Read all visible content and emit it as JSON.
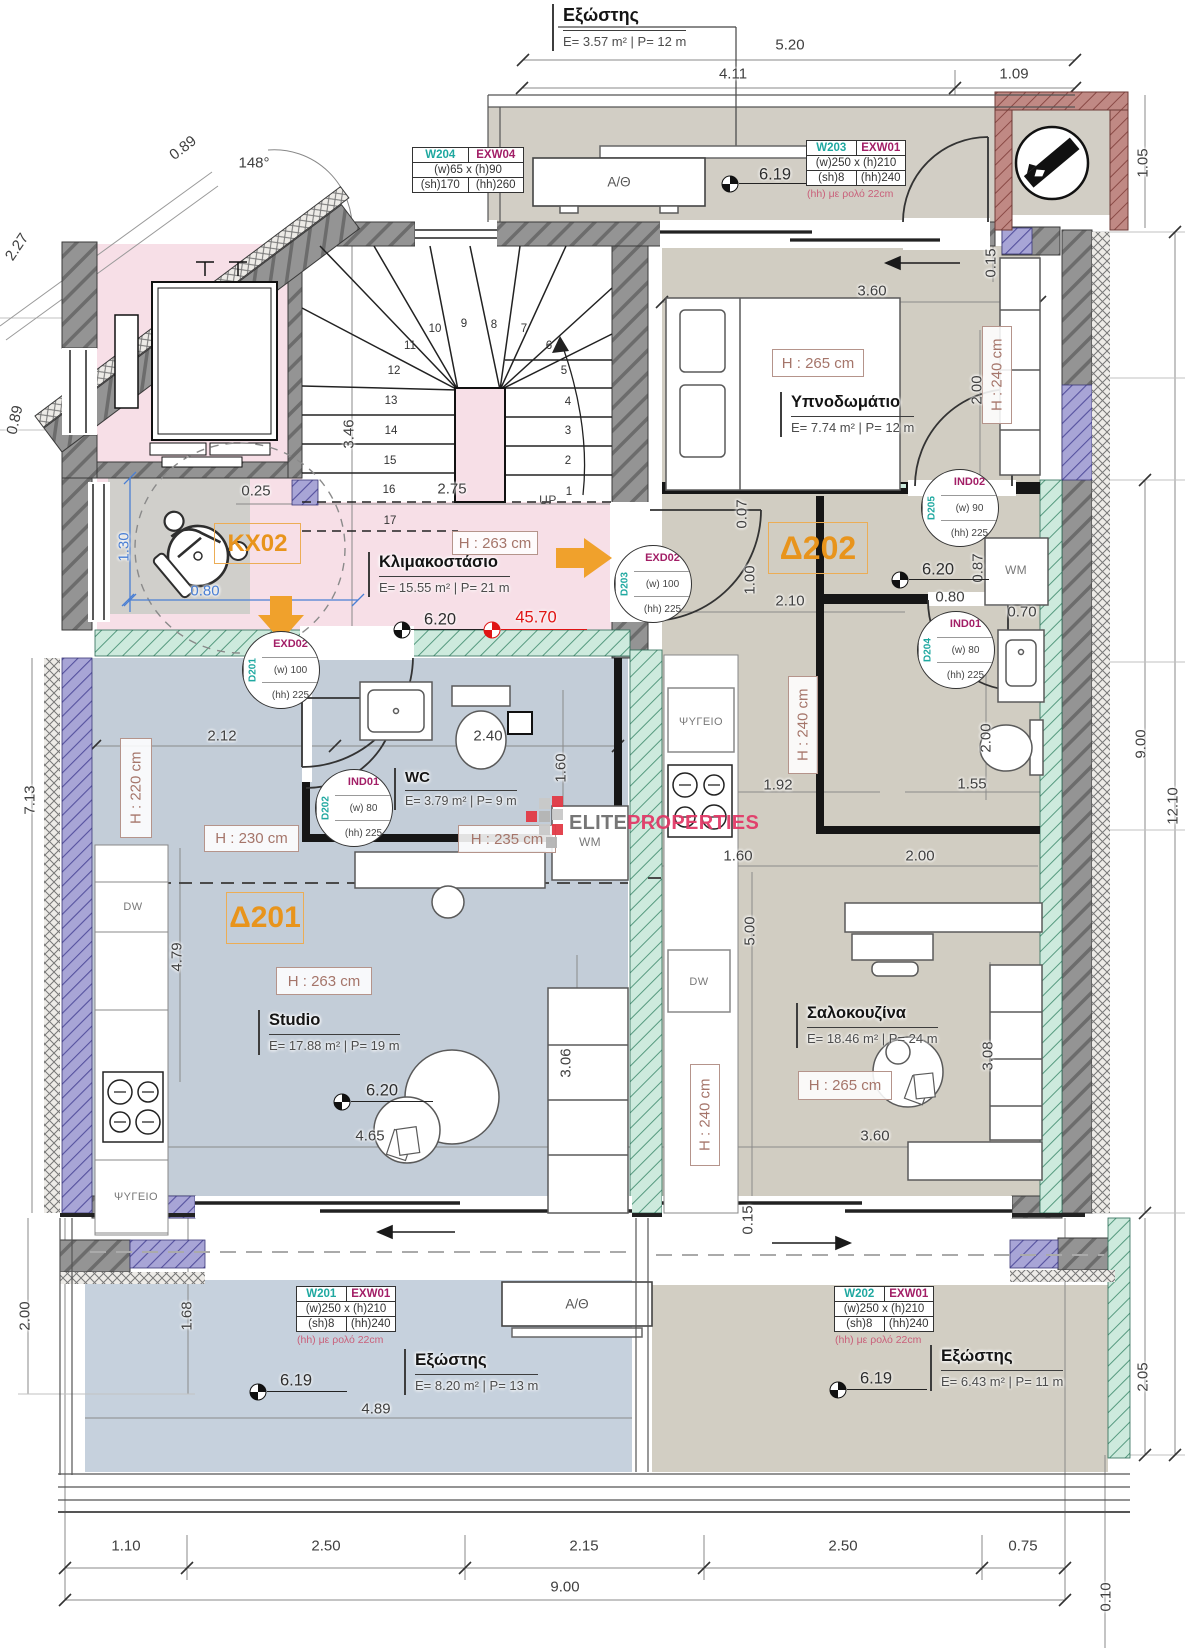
{
  "colors": {
    "accent_orange": "#E8941C",
    "tag_teal": "#1FA8A0",
    "tag_magenta": "#A21E66",
    "note_pink": "#C9607A",
    "level_red": "#E01414",
    "dim_blue": "#4A7FD4",
    "height_label": "#A5756A",
    "brand_pink": "#E23A68",
    "floor_pink": "#F7DFE7",
    "floor_blue": "#C3CDD8",
    "floor_taupe": "#D1CDC2"
  },
  "brand": {
    "gray": "ELITE",
    "pink": "PROPERTIES"
  },
  "balcony_top": {
    "name": "Εξώστης",
    "specs": "E= 3.57 m² | P= 12 m",
    "unit_label": "A/Θ"
  },
  "rooms": {
    "stairwell": {
      "tag": "KX02",
      "name": "Κλιμακοστάσιο",
      "specs": "E= 15.55 m² | P= 21 m",
      "height": "H : 263 cm"
    },
    "studio": {
      "tag": "Δ201",
      "name": "Studio",
      "specs": "E= 17.88 m² | P= 19 m",
      "height_main": "H : 263 cm",
      "height_entry": "H : 230 cm",
      "height_kitchen": "H : 220 cm"
    },
    "wc": {
      "name": "WC",
      "specs": "E= 3.79 m² | P= 9 m",
      "height": "H : 235 cm",
      "wm_label": "WM"
    },
    "apartment2": {
      "tag": "Δ202"
    },
    "bedroom": {
      "name": "Υπνοδωμάτιο",
      "specs": "E= 7.74 m² | P= 12 m",
      "height": "H : 265 cm",
      "height_right": "H : 240 cm",
      "wm_label": "WM"
    },
    "living": {
      "name": "Σαλοκουζίνα",
      "specs": "E= 18.46 m² | P= 24 m",
      "height": "H : 265 cm",
      "height_mid": "H : 240 cm",
      "height_col": "H : 240 cm"
    },
    "balcony_left": {
      "name": "Εξώστης",
      "specs": "E= 8.20 m² | P= 13 m",
      "unit_label": "A/Θ"
    },
    "balcony_right": {
      "name": "Εξώστης",
      "specs": "E= 6.43 m² | P= 11 m"
    }
  },
  "appliances": {
    "fridge_left": "ΨΥΓΕΙΟ",
    "fridge_mid": "ΨΥΓΕΙΟ",
    "dw_left": "DW",
    "dw_mid": "DW"
  },
  "stair": {
    "up": "UP",
    "numbers": [
      {
        "n": "1",
        "x": 569,
        "y": 492
      },
      {
        "n": "2",
        "x": 568,
        "y": 461
      },
      {
        "n": "3",
        "x": 568,
        "y": 431
      },
      {
        "n": "4",
        "x": 568,
        "y": 402
      },
      {
        "n": "5",
        "x": 564,
        "y": 371
      },
      {
        "n": "6",
        "x": 549,
        "y": 346
      },
      {
        "n": "7",
        "x": 524,
        "y": 329
      },
      {
        "n": "8",
        "x": 494,
        "y": 325
      },
      {
        "n": "9",
        "x": 464,
        "y": 324
      },
      {
        "n": "10",
        "x": 435,
        "y": 329
      },
      {
        "n": "11",
        "x": 410,
        "y": 346
      },
      {
        "n": "12",
        "x": 394,
        "y": 371
      },
      {
        "n": "13",
        "x": 391,
        "y": 401
      },
      {
        "n": "14",
        "x": 391,
        "y": 431
      },
      {
        "n": "15",
        "x": 390,
        "y": 461
      },
      {
        "n": "16",
        "x": 389,
        "y": 490
      },
      {
        "n": "17",
        "x": 390,
        "y": 521
      }
    ]
  },
  "door_tags": [
    {
      "id": "D201",
      "type": "EXD02",
      "w": "(w) 100",
      "hh": "(hh) 225",
      "x": 281,
      "y": 670
    },
    {
      "id": "D202",
      "type": "IND01",
      "w": "(w) 80",
      "hh": "(hh) 225",
      "x": 354,
      "y": 808
    },
    {
      "id": "D203",
      "type": "EXD02",
      "w": "(w) 100",
      "hh": "(hh) 225",
      "x": 653,
      "y": 584
    },
    {
      "id": "D204",
      "type": "IND01",
      "w": "(w) 80",
      "hh": "(hh) 225",
      "x": 956,
      "y": 650
    },
    {
      "id": "D205",
      "type": "IND02",
      "w": "(w) 90",
      "hh": "(hh) 225",
      "x": 960,
      "y": 508
    }
  ],
  "window_tables": [
    {
      "win": "W204",
      "type": "EXW04",
      "size": "(w)65 x (h)90",
      "sh": "(sh)170",
      "hh": "(hh)260",
      "note": "",
      "x": 412,
      "y": 147,
      "w": 112
    },
    {
      "win": "W203",
      "type": "EXW01",
      "size": "(w)250 x (h)210",
      "sh": "(sh)8",
      "hh": "(hh)240",
      "note": "(hh) με ρολό 22cm",
      "x": 806,
      "y": 140,
      "w": 100
    },
    {
      "win": "W201",
      "type": "EXW01",
      "size": "(w)250 x (h)210",
      "sh": "(sh)8",
      "hh": "(hh)240",
      "note": "(hh) με ρολό 22cm",
      "x": 296,
      "y": 1286,
      "w": 100
    },
    {
      "win": "W202",
      "type": "EXW01",
      "size": "(w)250 x (h)210",
      "sh": "(sh)8",
      "hh": "(hh)240",
      "note": "(hh) με ρολό 22cm",
      "x": 834,
      "y": 1286,
      "w": 100
    }
  ],
  "levels": [
    {
      "v": "6.19",
      "x": 730,
      "y": 184,
      "tx": 775,
      "ty": 175
    },
    {
      "v": "6.20",
      "x": 402,
      "y": 630,
      "tx": 440,
      "ty": 620
    },
    {
      "v": "45.70",
      "x": 492,
      "y": 630,
      "tx": 536,
      "ty": 618,
      "red": true
    },
    {
      "v": "6.20",
      "x": 900,
      "y": 580,
      "tx": 938,
      "ty": 570
    },
    {
      "v": "6.20",
      "x": 342,
      "y": 1102,
      "tx": 382,
      "ty": 1091
    },
    {
      "v": "6.19",
      "x": 258,
      "y": 1392,
      "tx": 296,
      "ty": 1381
    },
    {
      "v": "6.19",
      "x": 838,
      "y": 1390,
      "tx": 876,
      "ty": 1379
    }
  ],
  "dims": [
    {
      "t": "5.20",
      "x": 790,
      "y": 45
    },
    {
      "t": "4.11",
      "x": 733,
      "y": 74
    },
    {
      "t": "1.09",
      "x": 1014,
      "y": 74
    },
    {
      "t": "1.05",
      "x": 1143,
      "y": 163,
      "r": -90
    },
    {
      "t": "0.89",
      "x": 183,
      "y": 148,
      "r": -38
    },
    {
      "t": "148°",
      "x": 254,
      "y": 163
    },
    {
      "t": "2.27",
      "x": 17,
      "y": 247,
      "r": -56
    },
    {
      "t": "0.89",
      "x": 15,
      "y": 420,
      "r": -77
    },
    {
      "t": "0.15",
      "x": 991,
      "y": 263,
      "r": -90
    },
    {
      "t": "3.60",
      "x": 872,
      "y": 291
    },
    {
      "t": "2.00",
      "x": 977,
      "y": 390,
      "r": -90
    },
    {
      "t": "0.07",
      "x": 742,
      "y": 514,
      "r": -90
    },
    {
      "t": "1.00",
      "x": 750,
      "y": 580,
      "r": -90
    },
    {
      "t": "2.10",
      "x": 790,
      "y": 601
    },
    {
      "t": "0.80",
      "x": 950,
      "y": 597
    },
    {
      "t": "0.87",
      "x": 978,
      "y": 568,
      "r": -90
    },
    {
      "t": "0.70",
      "x": 1022,
      "y": 612
    },
    {
      "t": "3.46",
      "x": 349,
      "y": 434,
      "r": -90
    },
    {
      "t": "0.25",
      "x": 256,
      "y": 491
    },
    {
      "t": "2.75",
      "x": 452,
      "y": 489
    },
    {
      "t": "0.80",
      "x": 205,
      "y": 591,
      "c": "blue"
    },
    {
      "t": "1.30",
      "x": 124,
      "y": 547,
      "r": -90,
      "c": "blue"
    },
    {
      "t": "2.12",
      "x": 222,
      "y": 736
    },
    {
      "t": "2.40",
      "x": 488,
      "y": 736
    },
    {
      "t": "1.60",
      "x": 561,
      "y": 768,
      "r": -90
    },
    {
      "t": "1.92",
      "x": 778,
      "y": 785
    },
    {
      "t": "2.00",
      "x": 986,
      "y": 738,
      "r": -90
    },
    {
      "t": "1.55",
      "x": 972,
      "y": 784
    },
    {
      "t": "9.00",
      "x": 1141,
      "y": 744,
      "r": -90
    },
    {
      "t": "12.10",
      "x": 1173,
      "y": 806,
      "r": -90
    },
    {
      "t": "1.60",
      "x": 738,
      "y": 856
    },
    {
      "t": "2.00",
      "x": 920,
      "y": 856
    },
    {
      "t": "5.00",
      "x": 750,
      "y": 931,
      "r": -90
    },
    {
      "t": "4.79",
      "x": 177,
      "y": 957,
      "r": -90
    },
    {
      "t": "7.13",
      "x": 30,
      "y": 800,
      "r": -90
    },
    {
      "t": "3.06",
      "x": 566,
      "y": 1063,
      "r": -90
    },
    {
      "t": "4.65",
      "x": 370,
      "y": 1136
    },
    {
      "t": "3.08",
      "x": 988,
      "y": 1056,
      "r": -90
    },
    {
      "t": "3.60",
      "x": 875,
      "y": 1136
    },
    {
      "t": "0.15",
      "x": 748,
      "y": 1220,
      "r": -90
    },
    {
      "t": "2.00",
      "x": 25,
      "y": 1316,
      "r": -90
    },
    {
      "t": "1.68",
      "x": 187,
      "y": 1316,
      "r": -90
    },
    {
      "t": "4.89",
      "x": 376,
      "y": 1409
    },
    {
      "t": "2.05",
      "x": 1143,
      "y": 1377,
      "r": -90
    },
    {
      "t": "1.10",
      "x": 126,
      "y": 1546
    },
    {
      "t": "2.50",
      "x": 326,
      "y": 1546
    },
    {
      "t": "2.15",
      "x": 584,
      "y": 1546
    },
    {
      "t": "2.50",
      "x": 843,
      "y": 1546
    },
    {
      "t": "0.75",
      "x": 1023,
      "y": 1546
    },
    {
      "t": "9.00",
      "x": 565,
      "y": 1587
    },
    {
      "t": "0.10",
      "x": 1106,
      "y": 1597,
      "r": -90
    }
  ]
}
